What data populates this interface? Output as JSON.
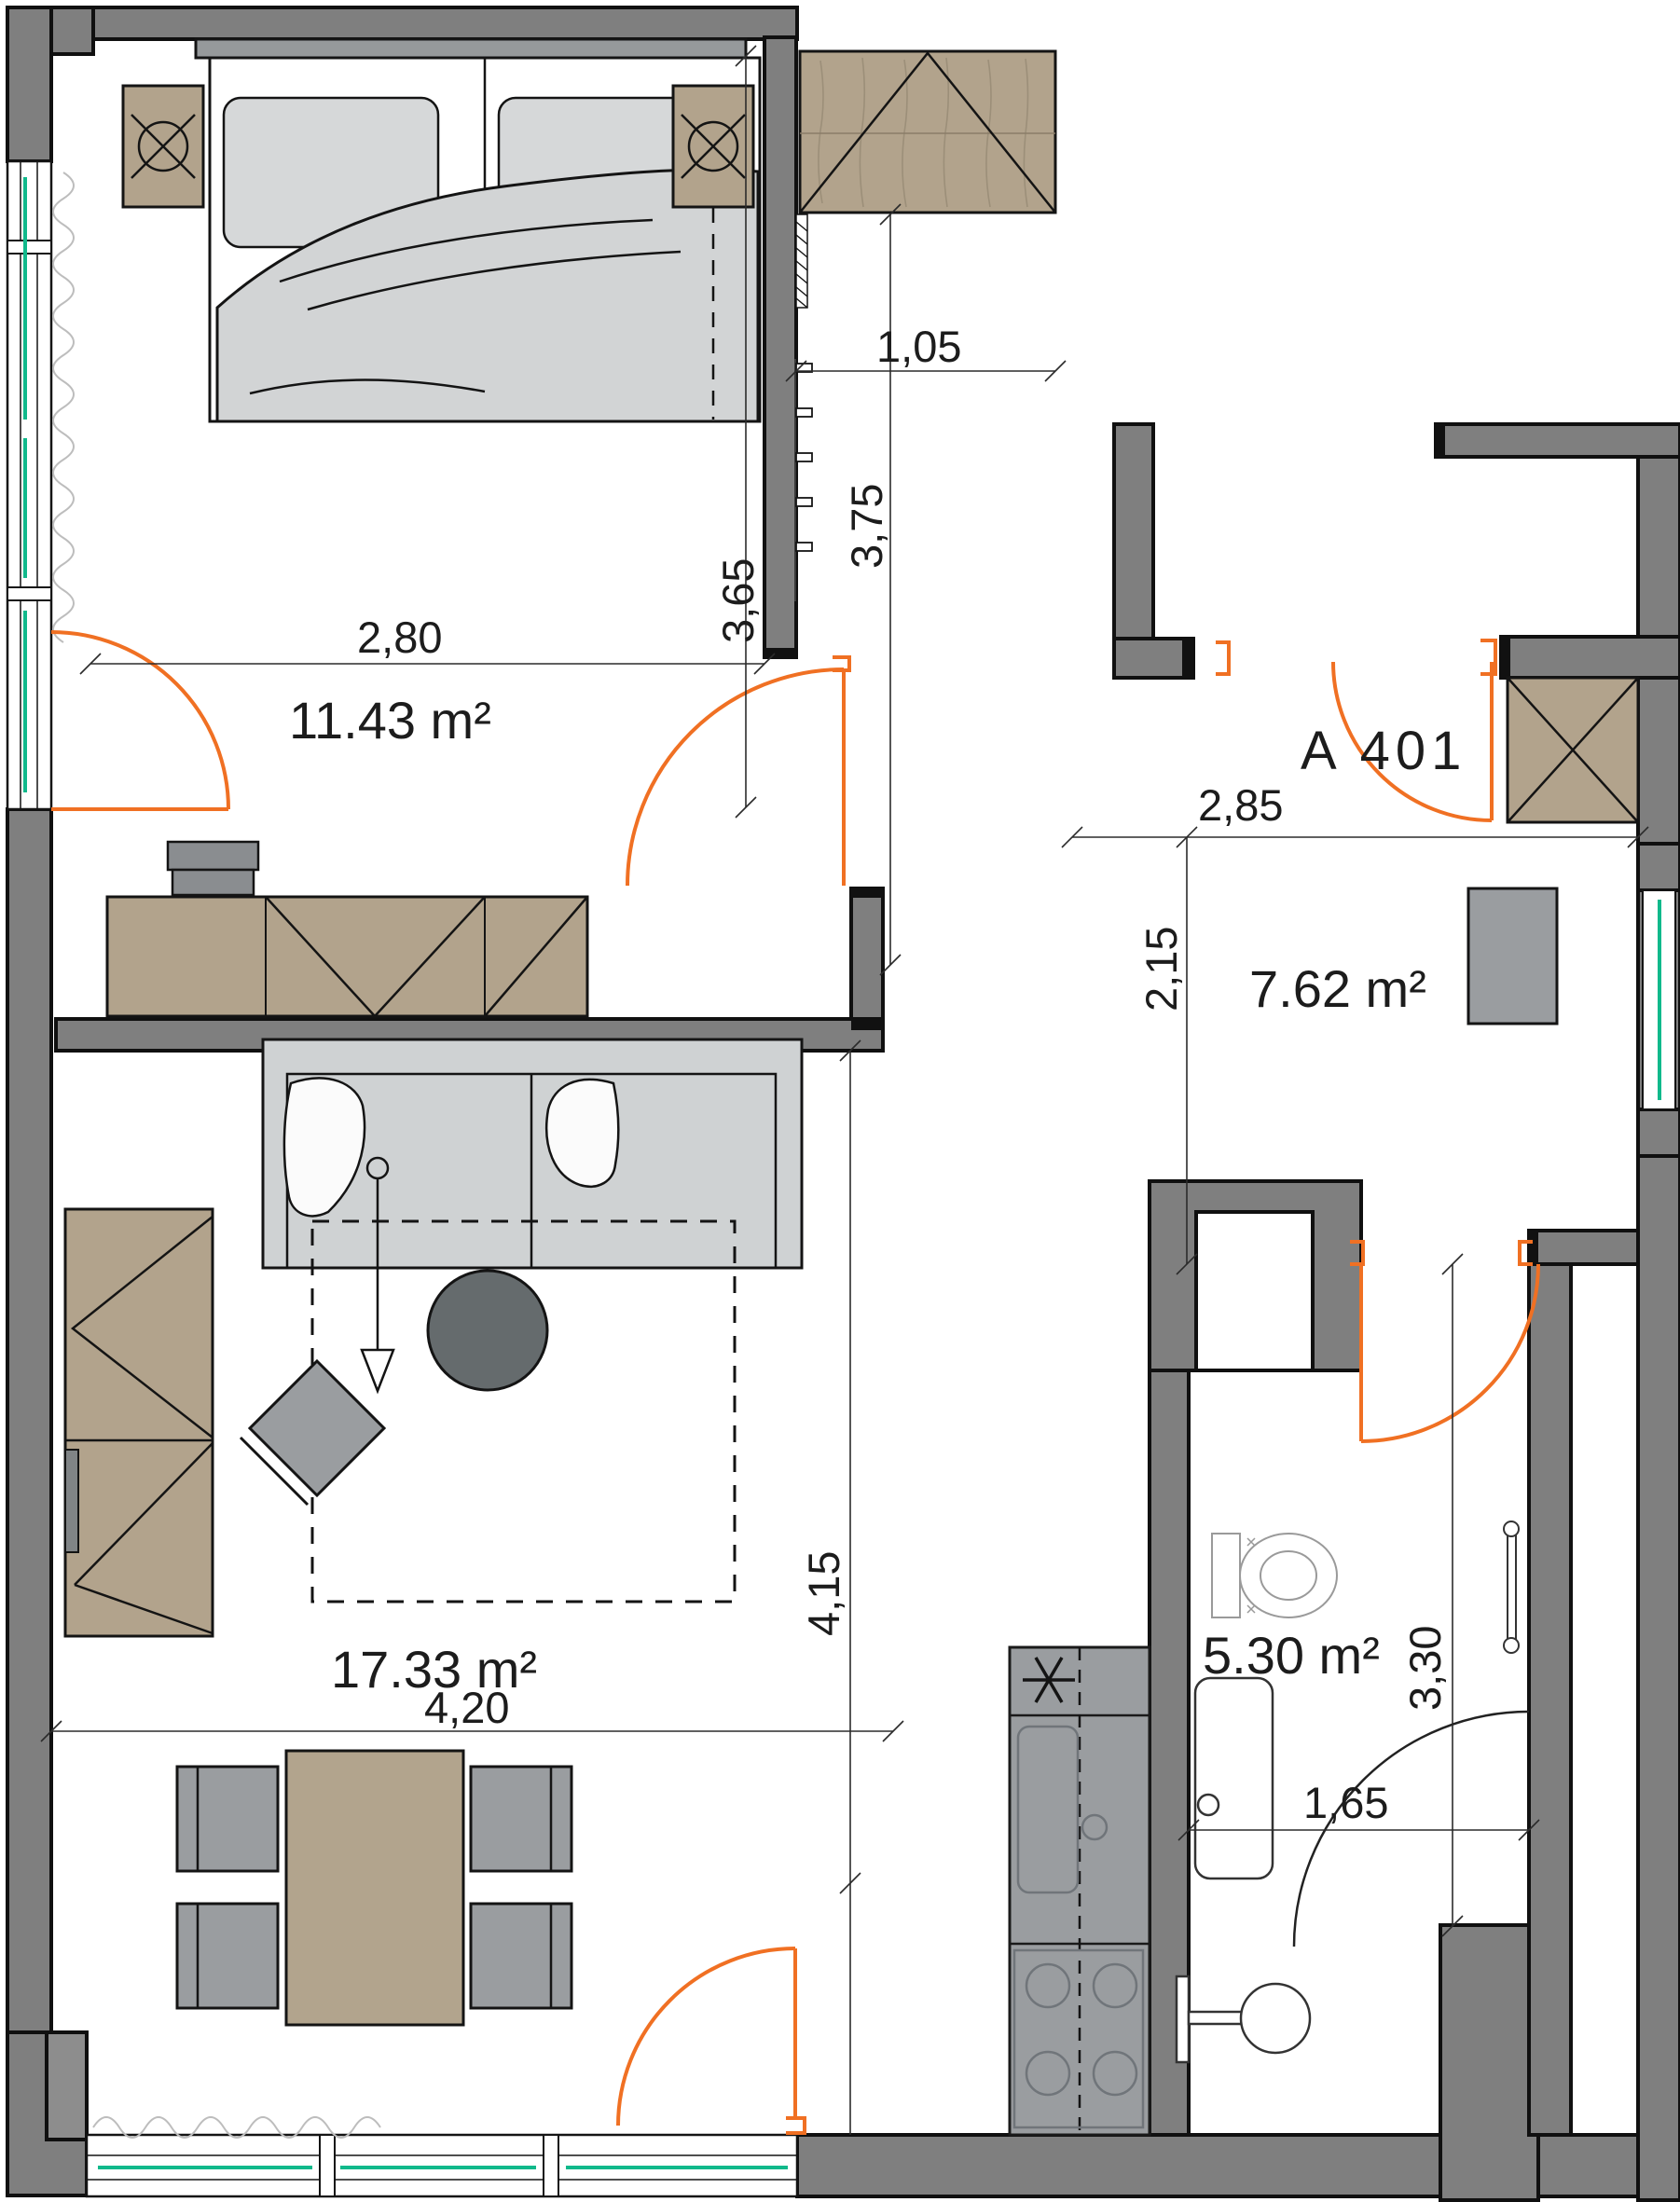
{
  "unit": {
    "label": "A 401"
  },
  "rooms": {
    "bedroom": {
      "area": "11.43 m²"
    },
    "living": {
      "area": "17.33 m²"
    },
    "hall": {
      "area": "7.62 m²"
    },
    "bathroom": {
      "area": "5.30 m²"
    }
  },
  "dimensions": {
    "bedroom_width": "2,80",
    "bedroom_depth": "3,65",
    "hall_niche_width": "1,05",
    "hall_depth": "3,75",
    "entry_width": "2,85",
    "hall_height": "2,15",
    "living_depth": "4,15",
    "living_width": "4,20",
    "bathroom_depth": "3,30",
    "bathroom_width": "1,65"
  },
  "legend": {
    "wall_color": "#7f7f7f",
    "furniture_wood_color": "#b2a38c",
    "furniture_soft_color": "#d3d5d6",
    "door_swing_color": "#f07023",
    "glazing_color": "#10b98b"
  }
}
